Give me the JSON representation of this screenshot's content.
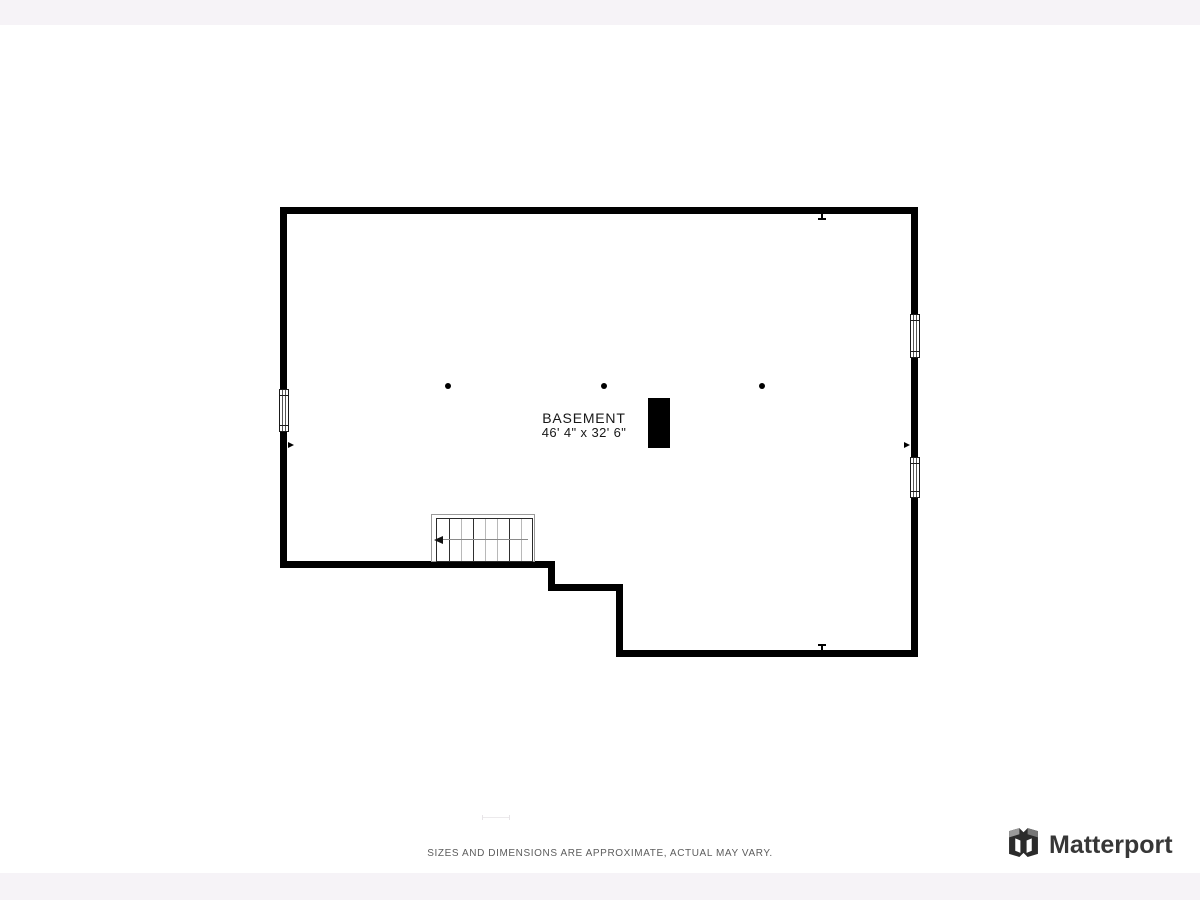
{
  "floor_plan": {
    "room_label": "BASEMENT",
    "room_dimensions": "46' 4\" x 32' 6\""
  },
  "footer": {
    "disclaimer": "SIZES AND DIMENSIONS ARE APPROXIMATE, ACTUAL MAY VARY."
  },
  "brand": {
    "name": "Matterport",
    "logo_icon": "matterport-cube-icon"
  },
  "colors": {
    "wall": "#000000",
    "page_band": "#f6f3f7",
    "disclaimer_text": "#5c5c5c",
    "brand_text": "#373737",
    "stair_tread_light": "#b8b8b8"
  }
}
